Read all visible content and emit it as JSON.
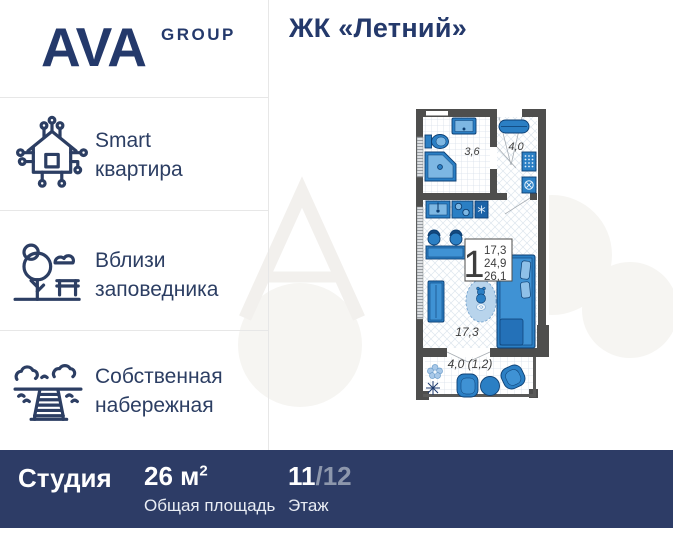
{
  "header": {
    "logo_main": "AVA",
    "logo_sub": "GROUP",
    "title": "ЖК «Летний»"
  },
  "sidebar": {
    "items": [
      {
        "icon": "smart-home-icon",
        "line1": "Smart",
        "line2": "квартира"
      },
      {
        "icon": "nature-reserve-icon",
        "line1": "Вблизи",
        "line2": "заповедника"
      },
      {
        "icon": "embankment-icon",
        "line1": "Собственная",
        "line2": "набережная"
      }
    ]
  },
  "floorplan": {
    "labels": {
      "bathroom": "3,6",
      "hallway": "4,0",
      "living_room": "17,3",
      "balcony": "4,0 (1,2)"
    },
    "info_box": {
      "room_count": "1",
      "living_area": "17,3",
      "apartment_area": "24,9",
      "total_area": "26,1"
    }
  },
  "footer": {
    "unit_type": "Студия",
    "area_value": "26 м",
    "area_sup": "2",
    "area_label": "Общая площадь",
    "floor_current": "11",
    "floor_rest": "/12",
    "floor_label": "Этаж"
  },
  "colors": {
    "brand_navy": "#24396b",
    "footer_bg": "#2d3c66",
    "plan_blue": "#2b7fc4",
    "wall_gray": "#4e4e4d"
  }
}
